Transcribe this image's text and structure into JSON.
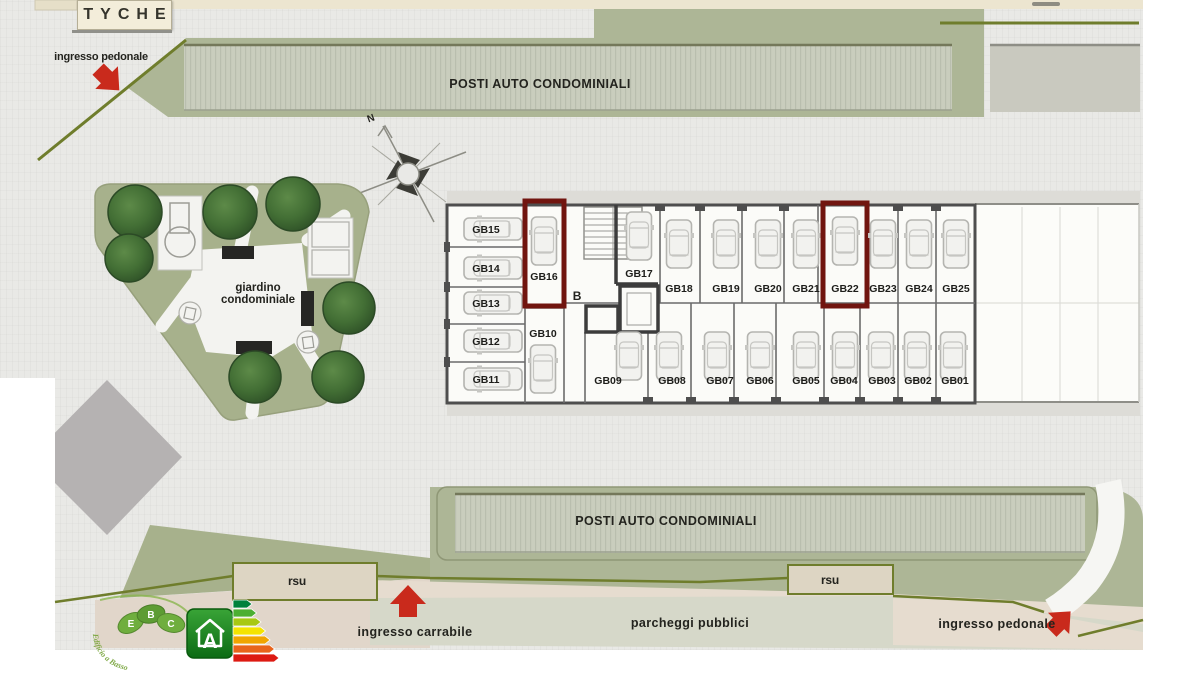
{
  "title": "TYCHE",
  "compass": {
    "north": "N"
  },
  "entrances": {
    "pedonale_top": "ingresso pedonale",
    "carrabile": "ingresso carrabile",
    "pedonale_bottom": "ingresso pedonale"
  },
  "parking": {
    "condominiale_top": "POSTI AUTO CONDOMINIALI",
    "condominiale_bottom": "POSTI AUTO CONDOMINIALI",
    "pubblici": "parcheggi pubblici"
  },
  "waste": {
    "left": "rsu",
    "right": "rsu"
  },
  "garden": {
    "label_line1": "giardino",
    "label_line2": "condominiale",
    "trees": [
      [
        135,
        212,
        27
      ],
      [
        129,
        258,
        24
      ],
      [
        230,
        212,
        27
      ],
      [
        293,
        204,
        27
      ],
      [
        349,
        308,
        26
      ],
      [
        338,
        377,
        26
      ],
      [
        255,
        377,
        26
      ]
    ]
  },
  "core": {
    "stair_label": "B"
  },
  "garages": {
    "highlighted": [
      "GB16",
      "GB22"
    ],
    "stalls": [
      {
        "id": "GB15",
        "lx": 486,
        "ly": 229,
        "cx": 493,
        "cy": 229,
        "dir": "h"
      },
      {
        "id": "GB14",
        "lx": 486,
        "ly": 268,
        "cx": 493,
        "cy": 268,
        "dir": "h"
      },
      {
        "id": "GB13",
        "lx": 486,
        "ly": 303,
        "cx": 493,
        "cy": 303,
        "dir": "h"
      },
      {
        "id": "GB12",
        "lx": 486,
        "ly": 341,
        "cx": 493,
        "cy": 341,
        "dir": "h"
      },
      {
        "id": "GB11",
        "lx": 486,
        "ly": 379,
        "cx": 493,
        "cy": 379,
        "dir": "h"
      },
      {
        "id": "GB16",
        "lx": 544,
        "ly": 276,
        "cx": 544,
        "cy": 241,
        "dir": "v",
        "hl": true,
        "box": [
          525,
          201,
          39,
          105
        ]
      },
      {
        "id": "GB10",
        "lx": 543,
        "ly": 333,
        "cx": 543,
        "cy": 369,
        "dir": "v"
      },
      {
        "id": "GB17",
        "lx": 639,
        "ly": 273,
        "cx": 639,
        "cy": 236,
        "dir": "v"
      },
      {
        "id": "GB18",
        "lx": 679,
        "ly": 288,
        "cx": 679,
        "cy": 244,
        "dir": "v"
      },
      {
        "id": "GB19",
        "lx": 726,
        "ly": 288,
        "cx": 726,
        "cy": 244,
        "dir": "v"
      },
      {
        "id": "GB20",
        "lx": 768,
        "ly": 288,
        "cx": 768,
        "cy": 244,
        "dir": "v"
      },
      {
        "id": "GB21",
        "lx": 806,
        "ly": 288,
        "cx": 806,
        "cy": 244,
        "dir": "v"
      },
      {
        "id": "GB22",
        "lx": 845,
        "ly": 288,
        "cx": 845,
        "cy": 241,
        "dir": "v",
        "hl": true,
        "box": [
          823,
          203,
          44,
          103
        ]
      },
      {
        "id": "GB23",
        "lx": 883,
        "ly": 288,
        "cx": 883,
        "cy": 244,
        "dir": "v"
      },
      {
        "id": "GB24",
        "lx": 919,
        "ly": 288,
        "cx": 919,
        "cy": 244,
        "dir": "v"
      },
      {
        "id": "GB25",
        "lx": 956,
        "ly": 288,
        "cx": 956,
        "cy": 244,
        "dir": "v"
      },
      {
        "id": "GB09",
        "lx": 608,
        "ly": 380,
        "cx": 629,
        "cy": 356,
        "dir": "v"
      },
      {
        "id": "GB08",
        "lx": 672,
        "ly": 380,
        "cx": 669,
        "cy": 356,
        "dir": "v"
      },
      {
        "id": "GB07",
        "lx": 720,
        "ly": 380,
        "cx": 717,
        "cy": 356,
        "dir": "v"
      },
      {
        "id": "GB06",
        "lx": 760,
        "ly": 380,
        "cx": 760,
        "cy": 356,
        "dir": "v"
      },
      {
        "id": "GB05",
        "lx": 806,
        "ly": 380,
        "cx": 806,
        "cy": 356,
        "dir": "v"
      },
      {
        "id": "GB04",
        "lx": 844,
        "ly": 380,
        "cx": 845,
        "cy": 356,
        "dir": "v"
      },
      {
        "id": "GB03",
        "lx": 882,
        "ly": 380,
        "cx": 881,
        "cy": 356,
        "dir": "v"
      },
      {
        "id": "GB02",
        "lx": 918,
        "ly": 380,
        "cx": 917,
        "cy": 356,
        "dir": "v"
      },
      {
        "id": "GB01",
        "lx": 955,
        "ly": 380,
        "cx": 953,
        "cy": 356,
        "dir": "v"
      }
    ]
  },
  "energy": {
    "ebc_letters": [
      "E",
      "B",
      "C"
    ],
    "ebc_text": "Edificio a Basso",
    "class_letter": "A",
    "scale_colors": [
      "#00813c",
      "#4caf32",
      "#a8c813",
      "#f4e300",
      "#f0a500",
      "#e8641b",
      "#dd1a12"
    ]
  },
  "colors": {
    "highlight": "#71150f",
    "arrow_red": "#c92a1c",
    "olive_boundary": "#6f7d2c",
    "sage_green": "#adb696",
    "cream": "#ece5d0"
  }
}
